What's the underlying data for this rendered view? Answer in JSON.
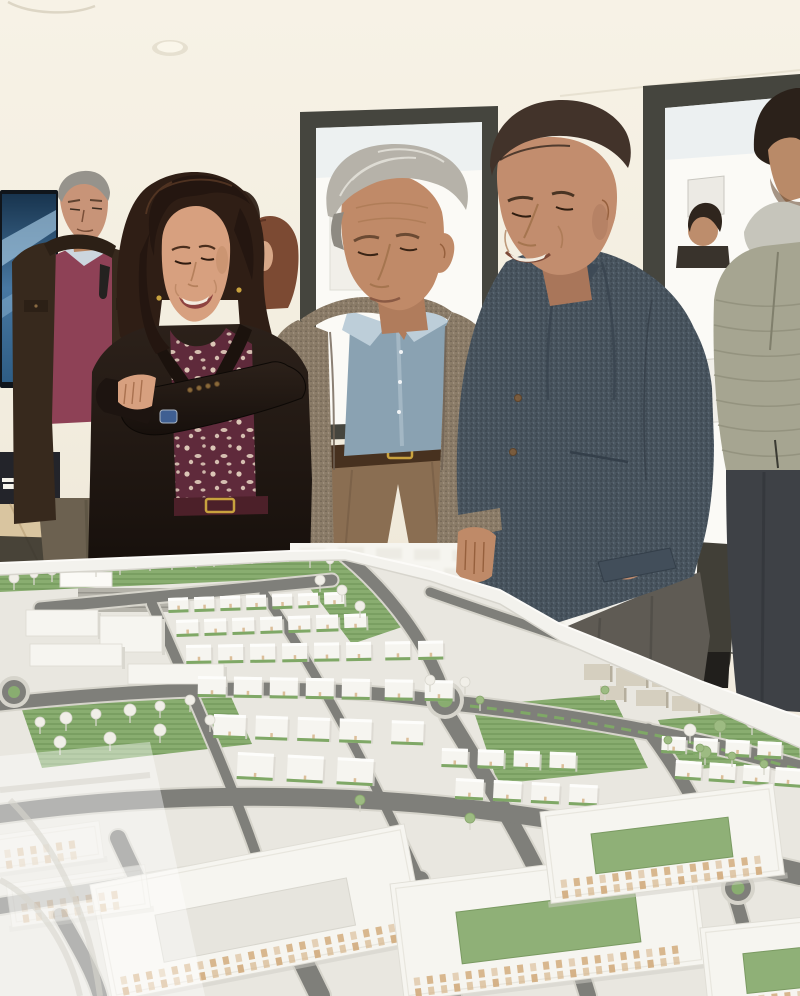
{
  "scene": {
    "type": "photograph",
    "description": "Indoor photo: a woman with long dark hair in a dark velvet blazer with arms crossed, an older gray-haired man in a taupe tweed blazer and blue chambray shirt, and a man in a navy tweed blazer with hand in pocket, all looking down at a large white architectural scale model of an urban development with roads, parks and housing blocks. Background: man in dark jacket and maroon sweater by a blue TV screen, other attendees, a person in an olive puffer jacket, tall dark-framed windows, cream walls and ceiling with recessed lights.",
    "colors": {
      "wall": "#f3eedf",
      "ceiling": "#f6f1e4",
      "windowFrame": "#45453e",
      "glass": "#fbfaf6",
      "glassTint": "#e7edef",
      "tvDark": "#10151b",
      "floorWood": "#d9c5a0",
      "sideboard": "#23242a",
      "man1Jacket": "#37291d",
      "man1Sweater": "#8e4156",
      "man1Hair": "#96938c",
      "man1Pants": "#6c6150",
      "womanHair": "#2f1e15",
      "womanSkin": "#d7a07f",
      "womanBlouse": "#5f2a3b",
      "womanBelt": "#4c2029",
      "man2Hair": "#b6b2a9",
      "man2Skin": "#c08a68",
      "man2Shirt": "#8aa2b2",
      "man2Blazer": "#8b7c68",
      "man2Pants": "#8a6e52",
      "man3Hair": "#42332a",
      "man3Skin": "#c28d6e",
      "man3Shirt": "#d3e1eb",
      "man3Blazer": "#49555f",
      "man3Pants": "#5f5b54",
      "pufferJacket": "#a6a591",
      "pufferCollar": "#c6c5bb",
      "pufferJeans": "#3e4146",
      "modelBase": "#e9e7e0",
      "rim": "#f3f2ed",
      "road": "#7f7f7a",
      "sidewalk": "#d6d4cb",
      "park": "#89ad70",
      "parkDark": "#6f9659",
      "block": "#f6f5f0",
      "blockShadow": "#d9d7cf",
      "windowTan": "#d2ab7c",
      "village": "#d5cfbf",
      "gold": "#c9a23e"
    },
    "people": [
      {
        "id": "man-background-left",
        "desc": "gray-haired man, dark brown jacket, maroon sweater, sunglasses on collar"
      },
      {
        "id": "young-man-background",
        "desc": "dark-haired young man, white shirt"
      },
      {
        "id": "woman-background",
        "desc": "woman with auburn hair"
      },
      {
        "id": "woman-foreground",
        "desc": "woman, long dark hair, dark velvet blazer, maroon floral blouse, arms crossed"
      },
      {
        "id": "man-foreground-center",
        "desc": "gray-haired man, taupe tweed blazer, chambray shirt, khaki trousers"
      },
      {
        "id": "man-foreground-right",
        "desc": "man, navy tweed blazer, light blue shirt, gray trousers, hand in pocket"
      },
      {
        "id": "man-window-background",
        "desc": "dark-haired head behind right man"
      },
      {
        "id": "person-boots-background",
        "desc": "dark silhouetted legs with boots by window"
      },
      {
        "id": "person-puffer-right",
        "desc": "person in olive quilted puffer jacket, arms crossed, dark jeans"
      }
    ],
    "model": {
      "roads": [
        {
          "d": "M40,608 L332,580",
          "w": 11
        },
        {
          "d": "M345,556 C380,585 422,632 443,690",
          "w": 12
        },
        {
          "d": "M0,704 C150,688 300,682 432,700",
          "w": 13
        },
        {
          "d": "M462,704 C560,714 690,736 800,768",
          "w": 15
        },
        {
          "d": "M430,592 C480,610 560,636 640,664 L703,690",
          "w": 9
        },
        {
          "d": "M152,604 C190,690 240,800 268,890",
          "w": 10
        },
        {
          "d": "M268,890 L320,996",
          "w": 20
        },
        {
          "d": "M264,594 C310,660 370,770 420,880",
          "w": 9
        },
        {
          "d": "M420,880 L452,996",
          "w": 18
        },
        {
          "d": "M448,716 C500,800 560,900 588,996",
          "w": 16
        },
        {
          "d": "M648,730 C700,800 740,880 758,996",
          "w": 13
        },
        {
          "d": "M0,814 C200,786 420,792 620,832",
          "w": 18
        },
        {
          "d": "M620,832 L800,874",
          "w": 22
        },
        {
          "d": "M0,906 L210,872",
          "w": 16
        },
        {
          "d": "M118,838 C132,870 152,906 168,948",
          "w": 16
        },
        {
          "d": "M60,915 C80,950 94,974 100,996",
          "w": 14
        },
        {
          "d": "M330,942 C500,926 650,938 800,964",
          "w": 14
        }
      ],
      "roundabouts": [
        {
          "cx": 445,
          "cy": 700,
          "r": 15
        },
        {
          "cx": 14,
          "cy": 692,
          "r": 12
        },
        {
          "cx": 738,
          "cy": 888,
          "r": 13
        }
      ],
      "parks": [
        {
          "points": "0,566 290,552 348,551 362,562 300,578 0,592"
        },
        {
          "points": "302,578 352,562 402,627 352,644"
        },
        {
          "points": "22,710 228,690 252,744 42,768"
        },
        {
          "points": "472,706 612,694 648,768 498,784"
        },
        {
          "points": "658,720 798,707 800,762 682,770"
        }
      ],
      "civic": [
        [
          26,
          610,
          72,
          26
        ],
        [
          100,
          616,
          62,
          36
        ],
        [
          30,
          644,
          92,
          22
        ],
        [
          128,
          664,
          96,
          20
        ]
      ],
      "canopy": {
        "x": 60,
        "y": 572,
        "w": 52,
        "h": 15
      },
      "parking": {
        "x": 78,
        "y": 588,
        "w": 92,
        "h": 24,
        "rows": 4
      },
      "villa_rows": [
        {
          "y": 598,
          "h": 12,
          "w": 20,
          "tilt": -2,
          "xs": [
            168,
            194,
            220,
            246,
            272,
            298,
            324
          ]
        },
        {
          "y": 620,
          "h": 14,
          "w": 22,
          "tilt": -2,
          "xs": [
            176,
            204,
            232,
            260,
            288,
            316,
            344
          ]
        },
        {
          "y": 645,
          "h": 16,
          "w": 25,
          "tilt": -1,
          "xs": [
            186,
            218,
            250,
            282,
            314,
            346,
            385,
            418
          ]
        },
        {
          "y": 676,
          "h": 18,
          "w": 28,
          "tilt": 1,
          "xs": [
            198,
            234,
            270,
            306,
            342,
            385,
            425
          ]
        },
        {
          "y": 714,
          "h": 21,
          "w": 32,
          "tilt": 2,
          "xs": [
            214,
            256,
            298,
            340,
            392
          ]
        },
        {
          "y": 752,
          "h": 24,
          "w": 36,
          "tilt": 3,
          "xs": [
            238,
            288,
            338
          ]
        },
        {
          "y": 736,
          "h": 14,
          "w": 24,
          "tilt": 3,
          "xs": [
            662,
            694,
            726,
            758
          ]
        },
        {
          "y": 760,
          "h": 16,
          "w": 26,
          "tilt": 4,
          "xs": [
            676,
            710,
            744,
            776
          ]
        },
        {
          "y": 748,
          "h": 16,
          "w": 26,
          "tilt": 2,
          "xs": [
            442,
            478,
            514,
            550
          ]
        },
        {
          "y": 778,
          "h": 18,
          "w": 28,
          "tilt": 3,
          "xs": [
            456,
            494,
            532,
            570
          ]
        }
      ],
      "village_boxes": [
        [
          584,
          664,
          26,
          16
        ],
        [
          616,
          668,
          30,
          18
        ],
        [
          652,
          672,
          26,
          15
        ],
        [
          688,
          678,
          30,
          17
        ],
        [
          600,
          686,
          24,
          14
        ],
        [
          636,
          690,
          30,
          16
        ],
        [
          672,
          696,
          26,
          15
        ],
        [
          710,
          700,
          24,
          14
        ],
        [
          620,
          660,
          20,
          12
        ]
      ],
      "apartment_blocks": [
        {
          "x": 90,
          "y": 885,
          "rot": -11,
          "w": 320,
          "h": 118,
          "court": [
            58,
            42,
            195,
            48
          ],
          "courtGreen": false
        },
        {
          "x": 390,
          "y": 884,
          "rot": -7,
          "w": 305,
          "h": 118,
          "court": [
            62,
            36,
            180,
            52
          ],
          "courtGreen": true
        },
        {
          "x": 540,
          "y": 812,
          "rot": -7,
          "w": 235,
          "h": 92,
          "court": [
            48,
            28,
            138,
            40
          ],
          "courtGreen": true
        },
        {
          "x": 700,
          "y": 928,
          "rot": -6,
          "w": 165,
          "h": 95,
          "court": [
            40,
            30,
            90,
            40
          ],
          "courtGreen": true
        },
        {
          "x": -10,
          "y": 836,
          "rot": -8,
          "w": 110,
          "h": 38,
          "court": null,
          "faded": true
        },
        {
          "x": 6,
          "y": 884,
          "rot": -8,
          "w": 140,
          "h": 44,
          "court": null,
          "faded": true
        }
      ],
      "trees": [
        [
          14,
          578,
          5,
          0
        ],
        [
          34,
          574,
          4,
          0
        ],
        [
          52,
          570,
          5,
          0
        ],
        [
          96,
          566,
          4,
          0
        ],
        [
          120,
          563,
          5,
          0
        ],
        [
          150,
          560,
          4,
          0
        ],
        [
          172,
          558,
          5,
          0
        ],
        [
          196,
          557,
          4,
          0
        ],
        [
          214,
          555,
          5,
          0
        ],
        [
          232,
          554,
          4,
          0
        ],
        [
          252,
          553,
          4,
          0
        ],
        [
          270,
          552,
          4,
          0
        ],
        [
          288,
          551,
          4,
          0
        ],
        [
          310,
          556,
          5,
          0
        ],
        [
          330,
          560,
          4,
          0
        ],
        [
          320,
          580,
          5,
          0
        ],
        [
          342,
          590,
          5,
          0
        ],
        [
          360,
          606,
          5,
          0
        ],
        [
          40,
          722,
          5,
          0
        ],
        [
          66,
          718,
          6,
          0
        ],
        [
          96,
          714,
          5,
          0
        ],
        [
          130,
          710,
          6,
          0
        ],
        [
          160,
          706,
          5,
          0
        ],
        [
          190,
          700,
          5,
          0
        ],
        [
          60,
          742,
          6,
          0
        ],
        [
          110,
          738,
          6,
          0
        ],
        [
          160,
          730,
          6,
          0
        ],
        [
          210,
          720,
          5,
          0
        ],
        [
          430,
          680,
          5,
          0
        ],
        [
          465,
          682,
          5,
          0
        ],
        [
          480,
          700,
          4,
          1
        ],
        [
          605,
          690,
          4,
          1
        ],
        [
          690,
          730,
          6,
          0
        ],
        [
          720,
          726,
          6,
          1
        ],
        [
          752,
          722,
          6,
          0
        ],
        [
          780,
          718,
          5,
          0
        ],
        [
          705,
          752,
          6,
          1
        ],
        [
          668,
          740,
          4,
          1
        ],
        [
          700,
          748,
          4,
          1
        ],
        [
          732,
          756,
          4,
          1
        ],
        [
          764,
          764,
          4,
          1
        ],
        [
          360,
          800,
          5,
          1
        ],
        [
          470,
          818,
          5,
          1
        ]
      ]
    }
  }
}
